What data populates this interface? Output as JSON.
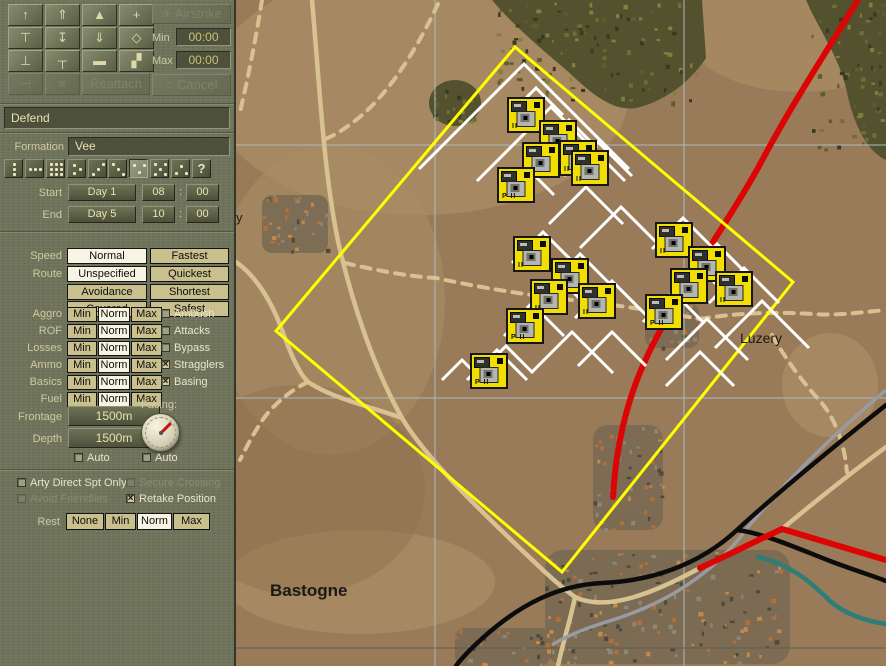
{
  "toolbar": {
    "grid_buttons": [
      {
        "name": "arrow-up-icon",
        "glyph": "↑",
        "disabled": false
      },
      {
        "name": "arrow-up-lines-icon",
        "glyph": "⇑",
        "disabled": false
      },
      {
        "name": "eject-icon",
        "glyph": "▲",
        "disabled": false
      },
      {
        "name": "crosshair-icon",
        "glyph": "+",
        "disabled": false
      },
      {
        "name": "bar-down-icon",
        "glyph": "⊤",
        "disabled": false
      },
      {
        "name": "arrow-into-bar-icon",
        "glyph": "↧",
        "disabled": false
      },
      {
        "name": "double-chevron-down-icon",
        "glyph": "⇓",
        "disabled": false
      },
      {
        "name": "diamond-target-icon",
        "glyph": "◇",
        "disabled": false
      },
      {
        "name": "ibeam-icon",
        "glyph": "⊥",
        "disabled": false
      },
      {
        "name": "t-handle-icon",
        "glyph": "┬",
        "disabled": false
      },
      {
        "name": "bone-icon",
        "glyph": "▬",
        "disabled": false
      },
      {
        "name": "split-squares-icon",
        "glyph": "▞",
        "disabled": false
      },
      {
        "name": "merge-left-icon",
        "glyph": "⊣",
        "disabled": true
      },
      {
        "name": "stack-lines-icon",
        "glyph": "≡",
        "disabled": true
      }
    ],
    "reattach_label": "Reattach",
    "airstrike_label": "Airstrike",
    "airstrike_glyph": "✈",
    "cancel_label": "Cancel",
    "cancel_glyph": "○",
    "min_label": "Min",
    "min_value": "00:00",
    "max_label": "Max",
    "max_value": "00:00"
  },
  "order": {
    "name": "Defend"
  },
  "formation": {
    "label": "Formation",
    "value": "Vee",
    "selected_index": 6,
    "unknown_glyph": "?",
    "buttons": [
      "column",
      "line",
      "mass",
      "wedge-right",
      "echelon-right",
      "echelon-left",
      "vee",
      "box",
      "wedge",
      "unknown"
    ]
  },
  "schedule": {
    "start_label": "Start",
    "end_label": "End",
    "colon": ":",
    "start": {
      "day": "Day 1",
      "hour": "08",
      "minute": "00"
    },
    "end": {
      "day": "Day 5",
      "hour": "10",
      "minute": "00"
    }
  },
  "movement": {
    "speed_label": "Speed",
    "route_label": "Route",
    "rows": [
      {
        "left": "Normal",
        "right": "Fastest",
        "selected": "left"
      },
      {
        "left": "Unspecified",
        "right": "Quickest",
        "selected": "left"
      },
      {
        "left": "Avoidance",
        "right": "Shortest",
        "selected": null
      },
      {
        "left": "Covered",
        "right": "Safest",
        "selected": null
      }
    ]
  },
  "levels": {
    "choices": [
      "Min",
      "Norm",
      "Max"
    ],
    "rows": [
      {
        "label": "Aggro",
        "selected": "Norm"
      },
      {
        "label": "ROF",
        "selected": "Norm"
      },
      {
        "label": "Losses",
        "selected": "Norm"
      },
      {
        "label": "Ammo",
        "selected": "Norm"
      },
      {
        "label": "Basics",
        "selected": "Norm"
      },
      {
        "label": "Fuel",
        "selected": "Norm"
      }
    ]
  },
  "tactics": [
    {
      "label": "Ambush",
      "checked": false,
      "disabled": false
    },
    {
      "label": "Attacks",
      "checked": false,
      "disabled": false
    },
    {
      "label": "Bypass",
      "checked": false,
      "disabled": false
    },
    {
      "label": "Stragglers",
      "checked": true,
      "disabled": false
    },
    {
      "label": "Basing",
      "checked": true,
      "disabled": false
    }
  ],
  "deployment": {
    "frontage_label": "Frontage",
    "frontage_value": "1500m",
    "depth_label": "Depth",
    "depth_value": "1500m",
    "facing_label": "Facing:",
    "facing_degrees": 45,
    "auto_frontage": "Auto",
    "auto_facing": "Auto"
  },
  "options": [
    {
      "label": "Arty Direct Spt Only",
      "checked": false,
      "disabled": false
    },
    {
      "label": "Secure Crossing",
      "checked": false,
      "disabled": true
    },
    {
      "label": "Avoid Friendlies",
      "checked": false,
      "disabled": true
    },
    {
      "label": "Retake Position",
      "checked": true,
      "disabled": false
    }
  ],
  "rest": {
    "label": "Rest",
    "choices": [
      "None",
      "Min",
      "Norm",
      "Max"
    ],
    "selected": "Norm"
  },
  "map": {
    "labels": [
      {
        "text": "Bastogne",
        "x": 270,
        "y": 581,
        "size": 17,
        "bold": true
      },
      {
        "text": "Luzery",
        "x": 740,
        "y": 330,
        "size": 14,
        "bold": false
      },
      {
        "text": "y",
        "x": 236,
        "y": 210,
        "size": 13,
        "bold": false
      }
    ],
    "units": [
      {
        "x": 526,
        "y": 115,
        "size": "II"
      },
      {
        "x": 558,
        "y": 138,
        "size": "II"
      },
      {
        "x": 541,
        "y": 160,
        "size": "II"
      },
      {
        "x": 578,
        "y": 158,
        "size": "II"
      },
      {
        "x": 590,
        "y": 168,
        "size": "II"
      },
      {
        "x": 516,
        "y": 185,
        "size": "P II"
      },
      {
        "x": 532,
        "y": 254,
        "size": "II"
      },
      {
        "x": 570,
        "y": 276,
        "size": "II"
      },
      {
        "x": 549,
        "y": 297,
        "size": "II"
      },
      {
        "x": 597,
        "y": 301,
        "size": "II"
      },
      {
        "x": 525,
        "y": 326,
        "size": "P II"
      },
      {
        "x": 674,
        "y": 240,
        "size": "II"
      },
      {
        "x": 707,
        "y": 264,
        "size": "II"
      },
      {
        "x": 689,
        "y": 286,
        "size": "II"
      },
      {
        "x": 734,
        "y": 289,
        "size": "II"
      },
      {
        "x": 664,
        "y": 312,
        "size": "P II"
      },
      {
        "x": 489,
        "y": 371,
        "size": "P II"
      }
    ],
    "arcs": [
      [
        524,
        64,
        105
      ],
      [
        551,
        107,
        74
      ],
      [
        536,
        88,
        27
      ],
      [
        569,
        120,
        28
      ],
      [
        549,
        142,
        30
      ],
      [
        598,
        142,
        34
      ],
      [
        527,
        168,
        27
      ],
      [
        586,
        187,
        37
      ],
      [
        621,
        207,
        41
      ],
      [
        543,
        232,
        31
      ],
      [
        580,
        254,
        31
      ],
      [
        558,
        277,
        31
      ],
      [
        612,
        281,
        37
      ],
      [
        534,
        306,
        30
      ],
      [
        572,
        332,
        41
      ],
      [
        612,
        332,
        34
      ],
      [
        506,
        346,
        27
      ],
      [
        683,
        218,
        31
      ],
      [
        717,
        244,
        31
      ],
      [
        699,
        267,
        31
      ],
      [
        744,
        268,
        35
      ],
      [
        673,
        292,
        30
      ],
      [
        707,
        319,
        41
      ],
      [
        762,
        301,
        47
      ],
      [
        700,
        352,
        34
      ],
      [
        497,
        350,
        30
      ],
      [
        462,
        360,
        20
      ]
    ],
    "task_box": [
      [
        515,
        47
      ],
      [
        793,
        282
      ],
      [
        562,
        572
      ],
      [
        276,
        331
      ]
    ],
    "colors": {
      "task_box": "#ffff00",
      "deploy_arc": "#ffffff",
      "counter": "#f2df00",
      "major_road": "#dd0404",
      "railroad": "#0c0c0c",
      "secondary_road": "#9a9aa2",
      "minor_road": "#d9c291",
      "river": "#2f7d78",
      "grid": "#a9bac2"
    }
  }
}
